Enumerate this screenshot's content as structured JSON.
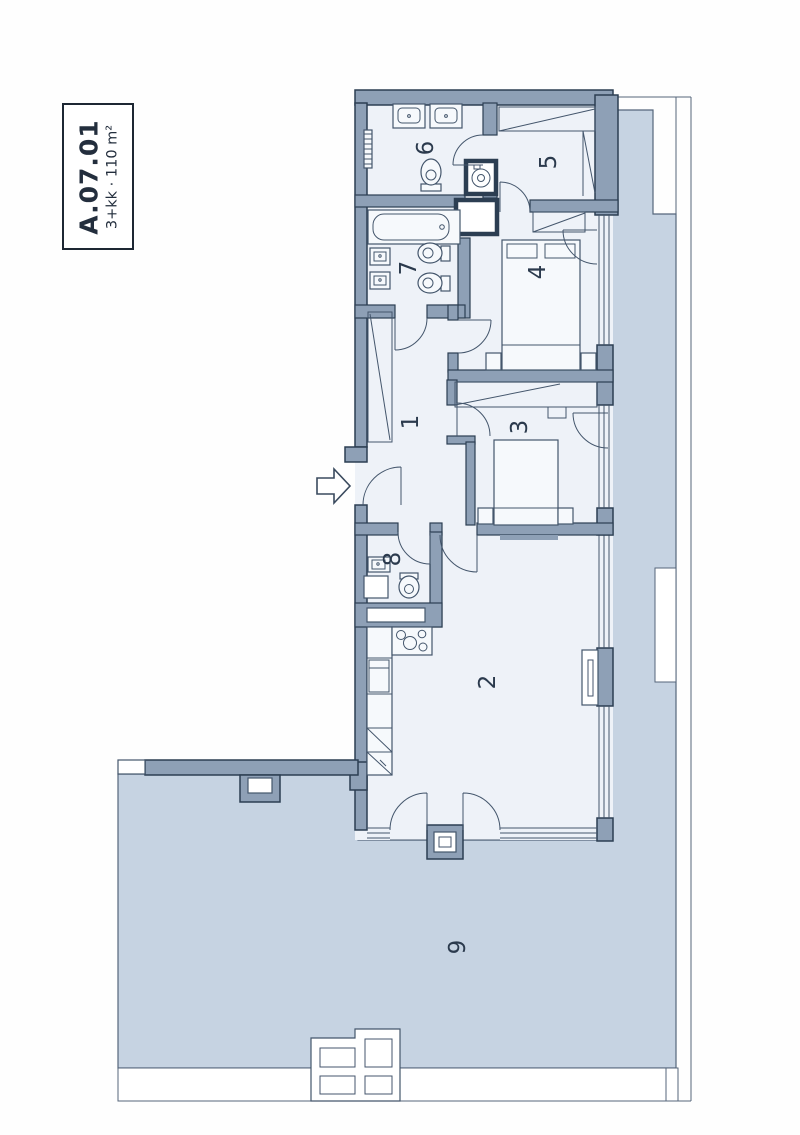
{
  "unit": {
    "code": "A.07.01",
    "type_area": "3+kk · 110 m²"
  },
  "rooms": [
    {
      "number": "1"
    },
    {
      "number": "2"
    },
    {
      "number": "3"
    },
    {
      "number": "4"
    },
    {
      "number": "5"
    },
    {
      "number": "6"
    },
    {
      "number": "7"
    },
    {
      "number": "8"
    },
    {
      "number": "9"
    }
  ],
  "colors": {
    "wall": "#8ea0b6",
    "wall_outline": "#2c3e52",
    "terrace": "#c6d3e2",
    "room_floor": "#eef2f8",
    "label_text": "#2b3a4d"
  }
}
